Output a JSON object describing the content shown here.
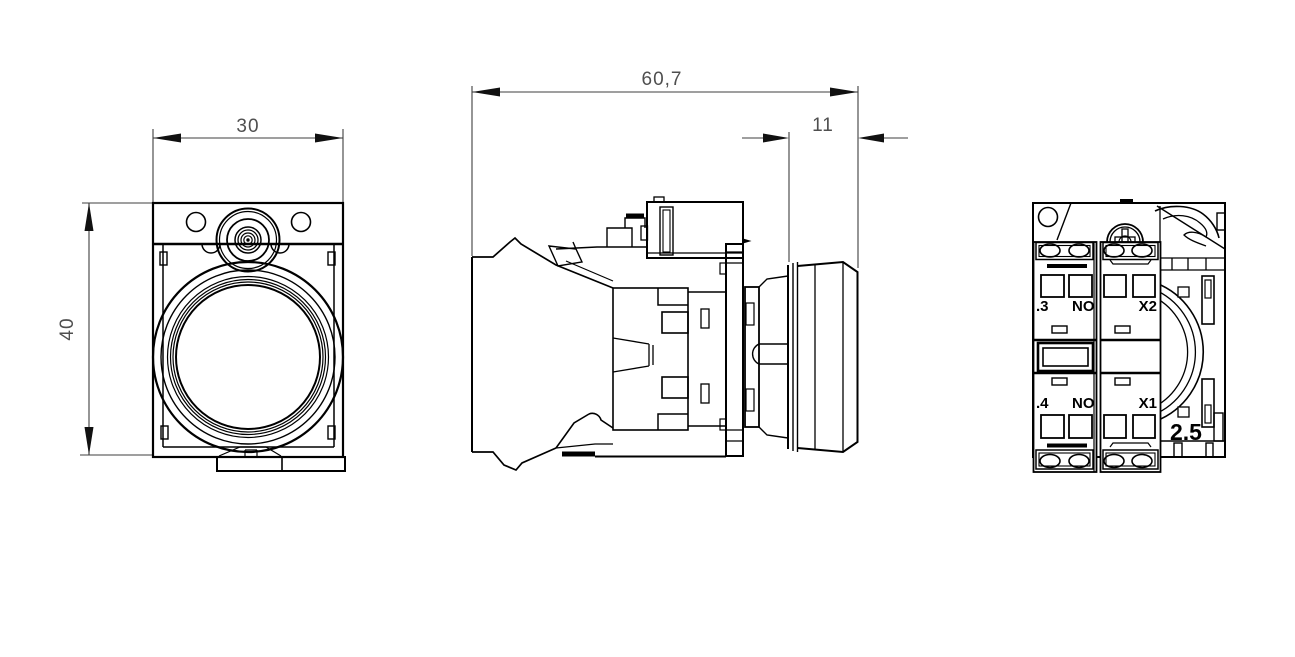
{
  "colors": {
    "background": "#ffffff",
    "line": "#000000",
    "dim_text": "#4f4f4f",
    "label_text": "#000000"
  },
  "front_view": {
    "width_dim": "30",
    "height_dim": "40"
  },
  "side_view": {
    "total_depth_dim": "60,7",
    "cap_depth_dim": "11"
  },
  "rear_view": {
    "terminal_3": ".3",
    "terminal_3_type": "NO",
    "lamp_terminal_x2": "X2",
    "terminal_4": ".4",
    "terminal_4_type": "NO",
    "lamp_terminal_x1": "X1",
    "wire_gauge": "2.5"
  }
}
